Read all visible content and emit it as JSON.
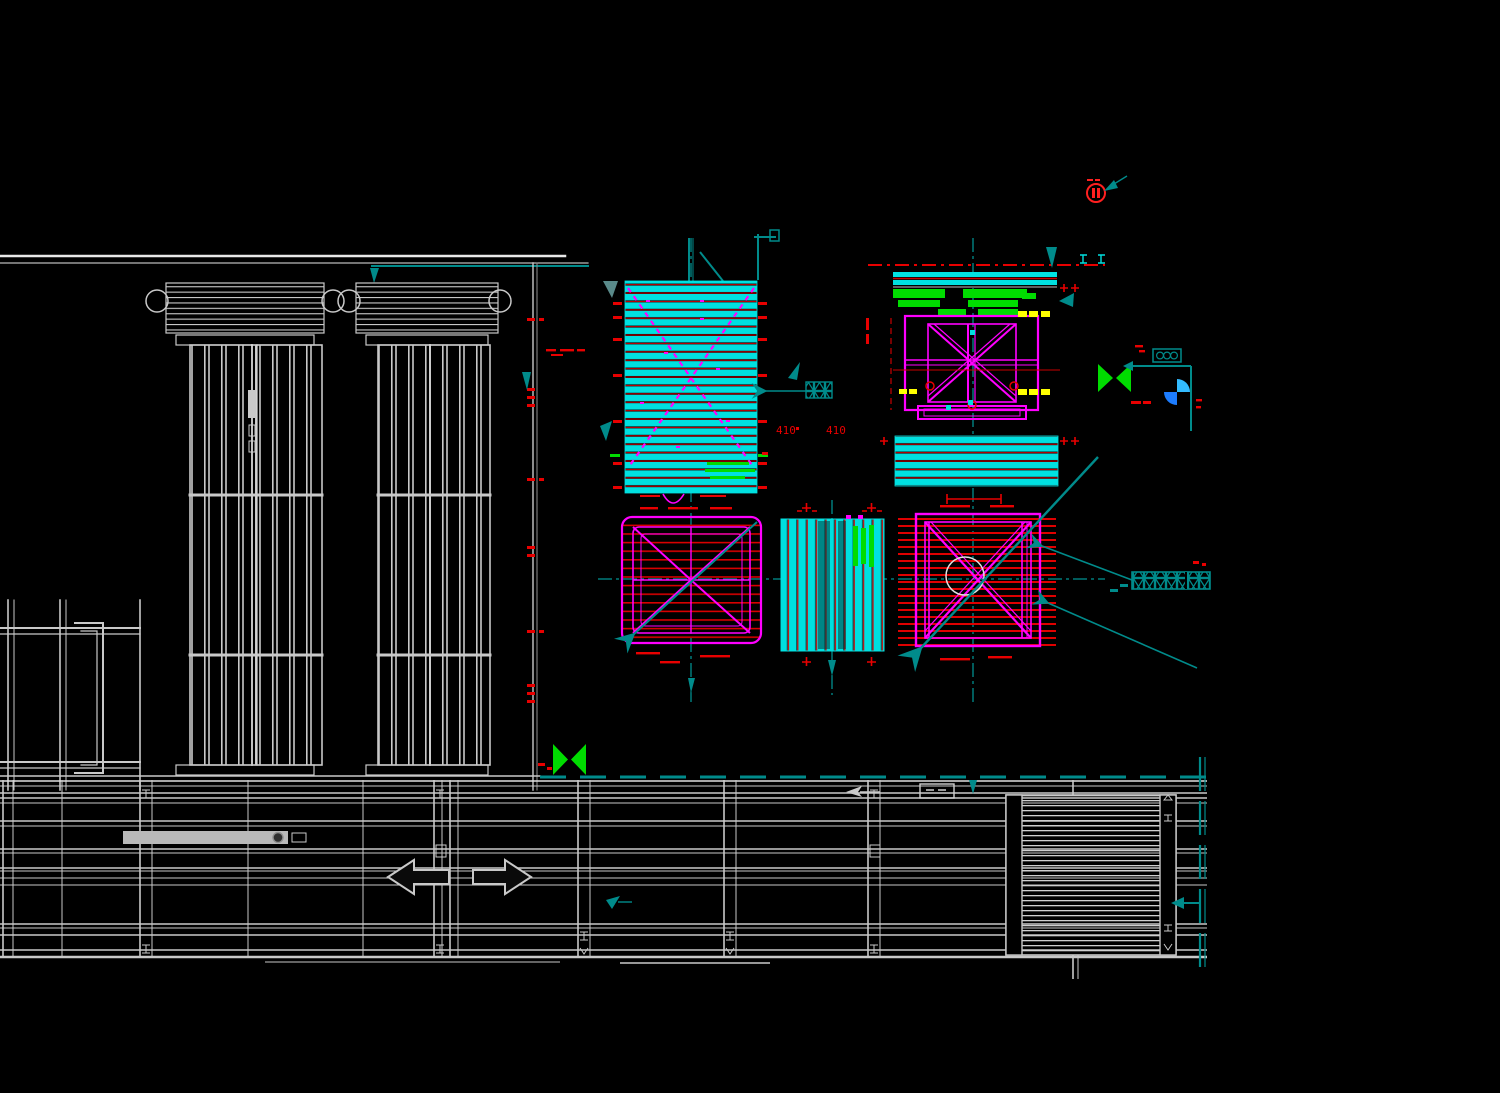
{
  "app": {
    "name": "cad-drawing-viewport",
    "description": "black-background CAD plan drawing of equipment foundations and steel structures"
  },
  "canvas": {
    "width": 1500,
    "height": 1093,
    "background": "#000000"
  },
  "labels": {
    "dim_410_a": "410",
    "dim_410_b": "410"
  },
  "colors": {
    "cyan": "#00E0E0",
    "teal": "#008B8B",
    "magenta": "#FF00FF",
    "red": "#E80000",
    "green": "#00DC00",
    "yellow": "#FFFF00",
    "blue_light": "#33BBFF",
    "blue": "#1D7DFF",
    "gray": "#C9C9C9",
    "white": "#F0F0F0",
    "black": "#000000"
  },
  "symbols": {
    "bowtie_upper": "green-bowtie-marker",
    "bowtie_lower": "green-bowtie-marker",
    "quadrant": "blue-quadrant-section-marker",
    "revision": "red-circle-revision-marker",
    "grating_tags": "teal-grating-tag"
  }
}
